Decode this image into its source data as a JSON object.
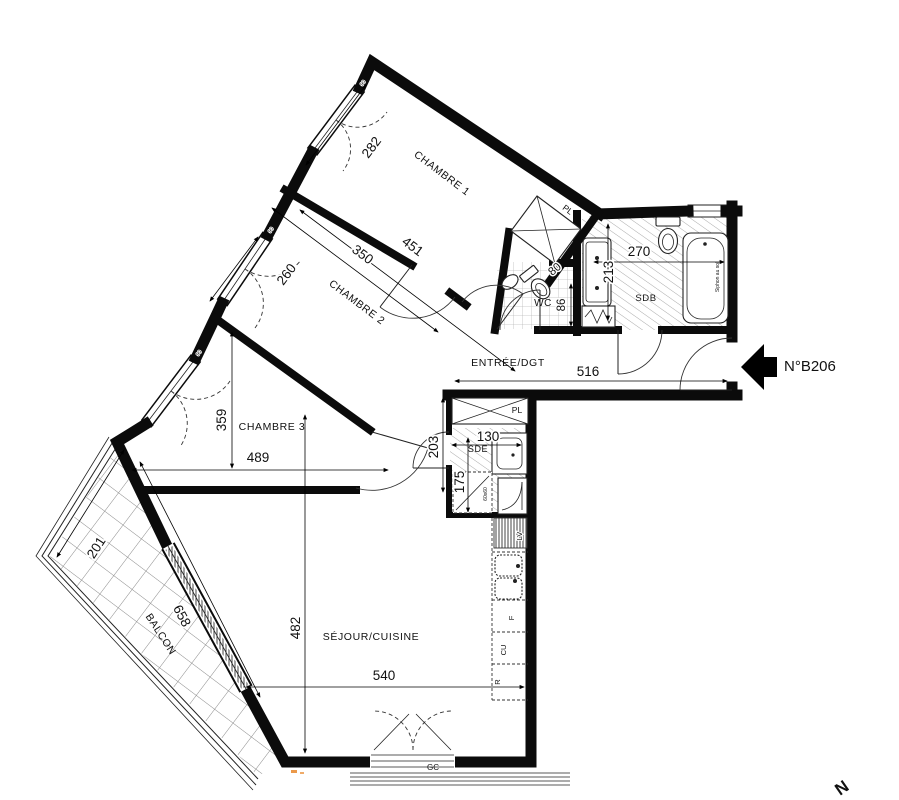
{
  "plan": {
    "unit": "N°B206",
    "north": "N",
    "rooms": {
      "chambre1": {
        "label": "CHAMBRE 1",
        "dim_width": "451",
        "dim_depth": "282"
      },
      "chambre2": {
        "label": "CHAMBRE 2",
        "dim_width": "350",
        "dim_depth": "260"
      },
      "chambre3": {
        "label": "CHAMBRE 3",
        "dim_width": "489",
        "dim_depth": "359"
      },
      "sejour": {
        "label": "SÉJOUR/CUISINE",
        "dim_width": "540",
        "dim_depth": "482"
      },
      "balcon": {
        "label": "BALCON",
        "dim_length": "658",
        "dim_depth": "201"
      },
      "entree": {
        "label": "ENTRÉE/DGT",
        "dim_width": "516"
      },
      "wc": {
        "label": "WC",
        "dim_width": "80",
        "dim_depth": "86"
      },
      "sdb": {
        "label": "SDB",
        "dim_width": "270",
        "dim_depth": "213"
      },
      "sde": {
        "label": "SDE",
        "dim_width": "130",
        "dim_height": "203",
        "dim_inner": "175"
      },
      "placard1": {
        "label": "PL"
      },
      "placard2": {
        "label": "PL"
      }
    },
    "kitchen": {
      "dishwasher": "LV",
      "oven": "F",
      "hob": "CU",
      "fridge": "R"
    },
    "annotations": {
      "railing": "GC",
      "floor_drain": "Siphon au sol",
      "washer_slot": "60x60",
      "window_tag": "90"
    },
    "colors": {
      "wall": "#0b0b0b",
      "hatch": "#9a9a9a",
      "mark": "#e8872a"
    }
  }
}
